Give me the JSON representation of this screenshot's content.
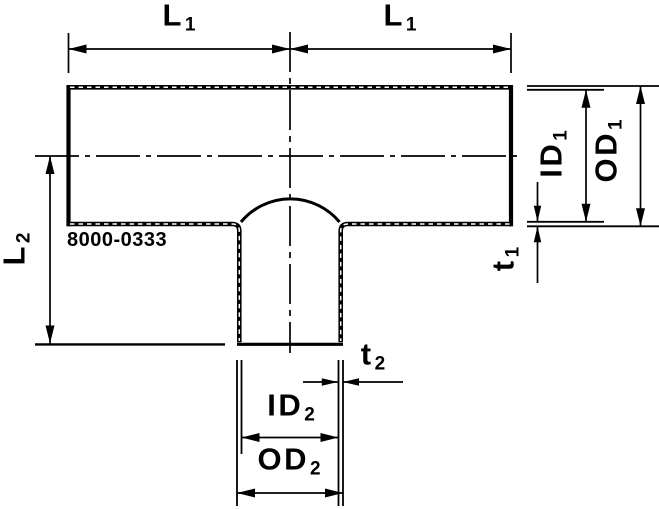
{
  "drawing": {
    "part_number": "8000-0333",
    "ink_color": "#000000",
    "background_color": "#ffffff",
    "labels": {
      "l1_left": {
        "base": "L",
        "sub": "1"
      },
      "l1_right": {
        "base": "L",
        "sub": "1"
      },
      "l2": {
        "base": "L",
        "sub": "2"
      },
      "id1": {
        "base": "ID",
        "sub": "1"
      },
      "od1": {
        "base": "OD",
        "sub": "1"
      },
      "t1": {
        "base": "t",
        "sub": "1"
      },
      "t2": {
        "base": "t",
        "sub": "2"
      },
      "id2": {
        "base": "ID",
        "sub": "2"
      },
      "od2": {
        "base": "OD",
        "sub": "2"
      }
    }
  }
}
